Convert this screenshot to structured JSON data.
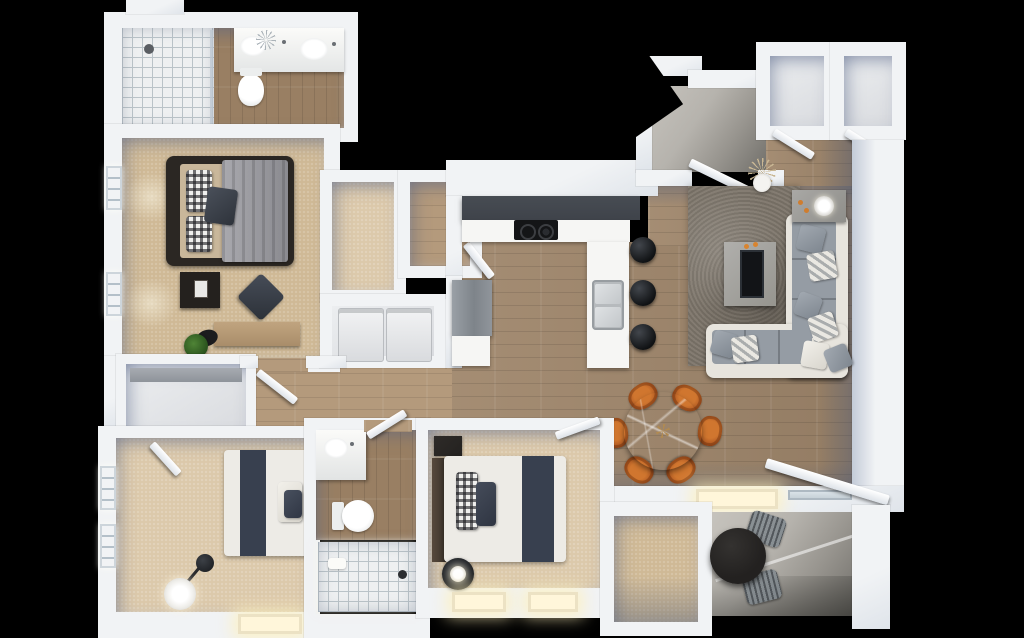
{
  "scene": {
    "type": "3d-floor-plan-render",
    "view": "top-down dollhouse cutaway",
    "background": "#000000",
    "units_visible_text": "none"
  },
  "colors": {
    "bg": "#000000",
    "wall": "#f1f3f5",
    "wall_shade": "#c3cbd8",
    "wood": "#a0876c",
    "wood_bath": "#997f63",
    "hall_wood": "#b49a7c",
    "carpet": "#cfb996",
    "carpet_light": "#dcc9ab",
    "tile": "#eef0f1",
    "tile_line": "#bac3c8",
    "concrete": "#b6b3ad",
    "concrete_dark": "#716f6a",
    "rug": "#7d756a",
    "cabinet_dark": "#3f434a",
    "counter": "#f6f6f4",
    "steel": "#c6cacd",
    "chair_orange": "#c06428",
    "marble_table": "#aba79f",
    "sofa_frame": "#e7e4dd",
    "sofa_cushion": "#959ca4",
    "bed_frame": "#2b2723",
    "mattress": "#c9b79a",
    "blanket_gray": "#9a9aa0",
    "duvet_white": "#edebe6",
    "runner_navy": "#38404f",
    "appliance_white": "#e9eaec",
    "fridge_gray": "#8b9096",
    "patio_table_dark": "#232120",
    "plant_green": "#3c6b2a",
    "window_glow": "#fff6da"
  },
  "rooms": {
    "master_bathroom": {
      "items": [
        "tiled-shower",
        "shower-head",
        "toilet",
        "double-vanity",
        "sink",
        "sink",
        "faucet-set",
        "decor-sprig"
      ]
    },
    "master_bedroom": {
      "items": [
        "queen-bed",
        "gray-blanket",
        "gingham-pillows",
        "dark-pillow",
        "nightstand",
        "photo-frame",
        "floor-pouf",
        "desk",
        "desk-chair",
        "potted-plant",
        "window",
        "window"
      ]
    },
    "walk_in_closet": {
      "items": [
        "carpet-floor",
        "door"
      ]
    },
    "second_closet": {
      "items": [
        "wood-floor",
        "door"
      ]
    },
    "laundry_closet": {
      "items": [
        "washer",
        "dryer"
      ]
    },
    "kitchen": {
      "items": [
        "upper-cabinets-dark",
        "cooktop",
        "burner",
        "burner",
        "counter-L",
        "double-sink",
        "faucet",
        "refrigerator",
        "base-cabinet",
        "bar-stool",
        "bar-stool",
        "bar-stool"
      ]
    },
    "entry_porch": {
      "items": [
        "concrete-landing",
        "entry-door"
      ]
    },
    "coat_closet_1": {
      "items": [
        "door"
      ]
    },
    "coat_closet_2": {
      "items": [
        "door"
      ]
    },
    "living_room": {
      "items": [
        "sectional-sofa",
        "area-rug",
        "tv-console",
        "tv",
        "side-table",
        "table-lamp",
        "candles",
        "throw-pillows-x8",
        "dry-plant-vase"
      ]
    },
    "dining_area": {
      "items": [
        "round-marble-table",
        "orange-chair",
        "orange-chair",
        "orange-chair",
        "orange-chair",
        "orange-chair",
        "orange-chair",
        "picture-window-lit"
      ]
    },
    "hallway": {
      "items": [
        "hall-closet",
        "shelf",
        "door",
        "door",
        "door",
        "door"
      ]
    },
    "bedroom_2": {
      "items": [
        "bed",
        "navy-runner",
        "gingham-pillow",
        "headboard",
        "dresser",
        "bedside-lamp",
        "lit-window",
        "lit-window",
        "door"
      ]
    },
    "bathroom_2": {
      "items": [
        "vanity-sink",
        "toilet",
        "walk-in-shower-tiled",
        "drain",
        "bath-pillow",
        "door"
      ]
    },
    "bedroom_3": {
      "items": [
        "bed",
        "navy-runner",
        "pillows",
        "arc-floor-lamp",
        "window",
        "window",
        "lit-window",
        "door"
      ]
    },
    "storage_closet": {
      "items": [
        "carpet-floor"
      ]
    },
    "balcony": {
      "items": [
        "round-cafe-table-dark",
        "mesh-chair",
        "mesh-chair",
        "sliding-glass-door",
        "concrete-floor",
        "parapet-shadow"
      ]
    }
  },
  "counts": {
    "bar_stools": 3,
    "dining_chairs": 6,
    "bedrooms": 3,
    "bathrooms": 2,
    "balcony_chairs": 2,
    "laundry_appliances": 2
  }
}
